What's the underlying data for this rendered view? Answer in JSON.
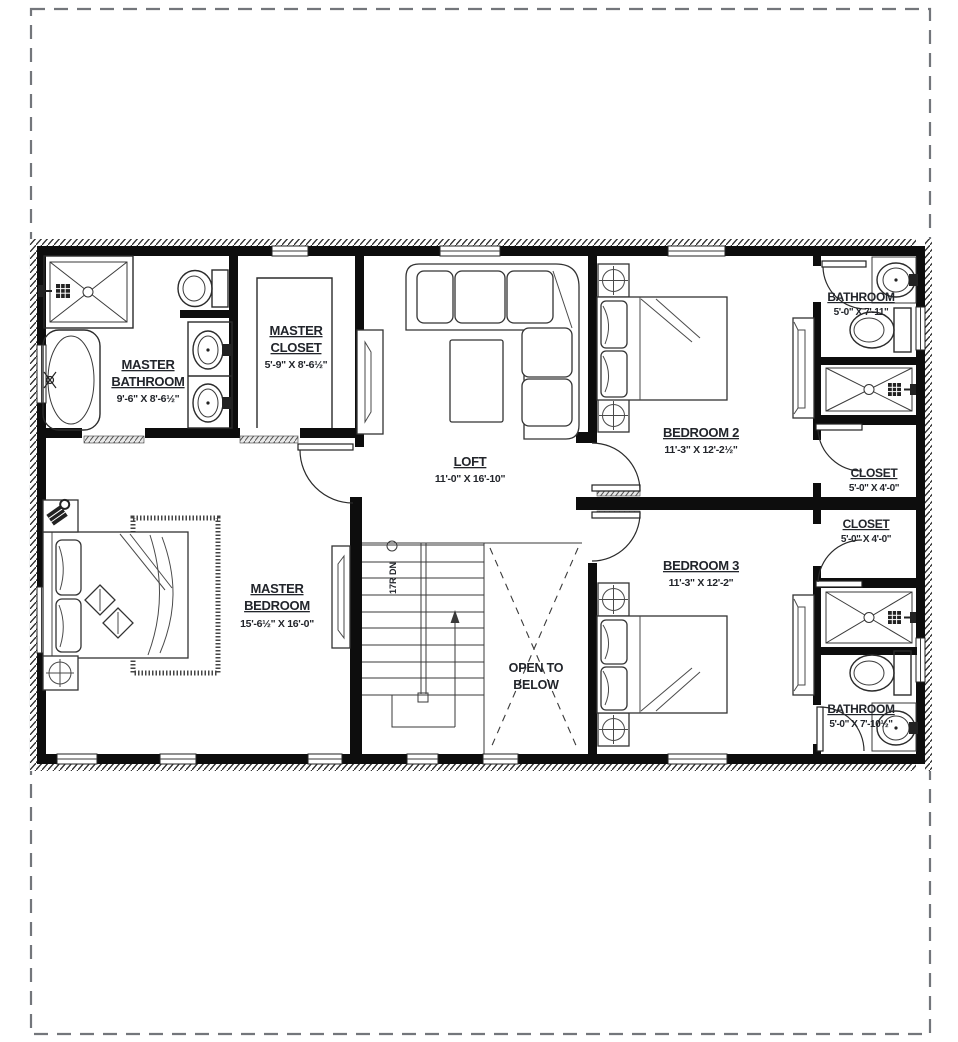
{
  "drawing": {
    "type": "second-floor plan",
    "colors": {
      "walls": "#0d0d0d",
      "label_text": "#22252b",
      "page_border": "#73767b"
    },
    "rooms": {
      "master_bathroom": {
        "line1": "MASTER",
        "line2": "BATHROOM",
        "dims": "9'-6\" X 8'-6½\""
      },
      "master_closet": {
        "line1": "MASTER",
        "line2": "CLOSET",
        "dims": "5'-9\" X 8'-6½\""
      },
      "loft": {
        "line1": "LOFT",
        "dims": "11'-0\" X 16'-10\""
      },
      "bedroom2": {
        "line1": "BEDROOM 2",
        "dims": "11'-3\" X 12'-2½\""
      },
      "bathroom_top": {
        "line1": "BATHROOM",
        "dims": "5'-0\" X 7'-11\""
      },
      "closet_top": {
        "line1": "CLOSET",
        "dims": "5'-0\" X 4'-0\""
      },
      "closet_bottom": {
        "line1": "CLOSET",
        "dims": "5'-0\" X 4'-0\""
      },
      "bedroom3": {
        "line1": "BEDROOM 3",
        "dims": "11'-3\" X 12'-2\""
      },
      "bathroom_bottom": {
        "line1": "BATHROOM",
        "dims": "5'-0\" X 7'-10½\""
      },
      "master_bedroom": {
        "line1": "MASTER",
        "line2": "BEDROOM",
        "dims": "15'-6½\" X 16'-0\""
      },
      "open_to_below": {
        "line1": "OPEN TO",
        "line2": "BELOW"
      }
    },
    "stairs": {
      "note": "17R DN"
    }
  }
}
